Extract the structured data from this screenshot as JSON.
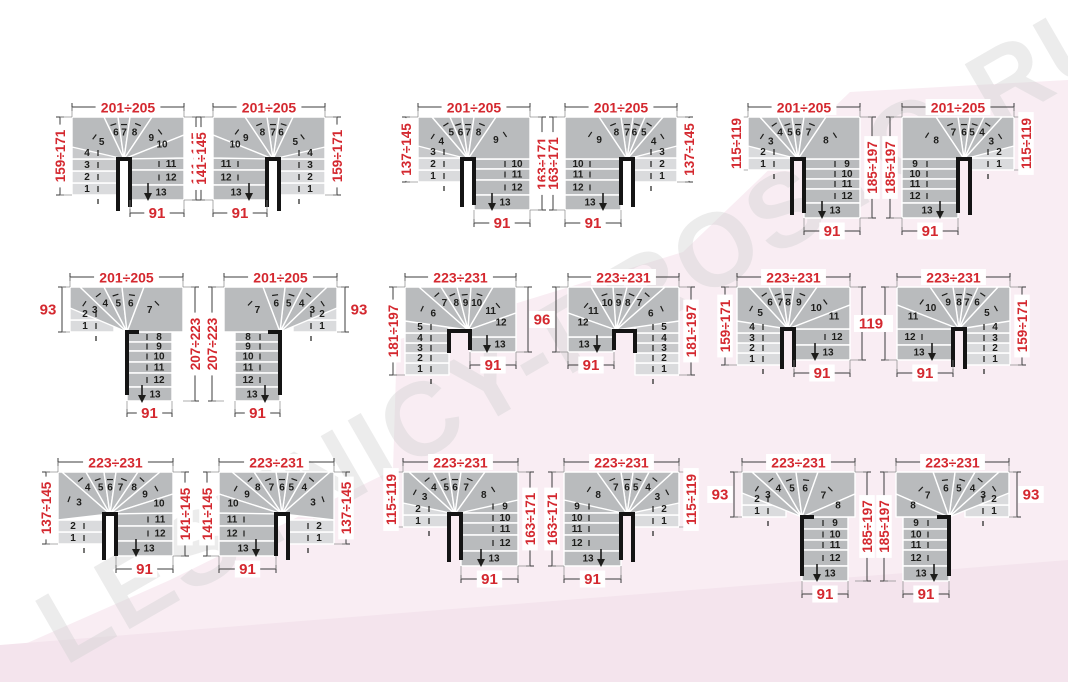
{
  "page": {
    "colors": {
      "background": "#ffffff",
      "pink_main": "#f9edf3",
      "pink_band": "#f4e4ed",
      "accent_red": "#d4282f",
      "step_dark": "#b9bbbd",
      "step_mid": "#c8c9cb",
      "step_light": "#dadbdd",
      "number": "#1d1d1b",
      "dim_line": "#3c3c3c",
      "wall": "#141414",
      "watermark": "#d2d2d2"
    },
    "watermark": {
      "text": "LESTNICY-PROSTO.RU"
    }
  },
  "diagrams": [
    {
      "dims": {
        "top": "201÷205",
        "left": "159÷171",
        "right": "141÷145",
        "bottom": "91"
      },
      "steps": {
        "entry": [
          "1",
          "2",
          "3",
          "4"
        ],
        "fan": [
          "5",
          "6",
          "7",
          "8",
          "9"
        ],
        "side": [
          "10"
        ],
        "flight": [
          "11",
          "12"
        ],
        "exit": "13"
      }
    },
    {
      "dims": {
        "top": "201÷205",
        "left": "141÷145",
        "right": "159÷171",
        "bottom": "91"
      },
      "steps": {
        "entry": [
          "1",
          "2",
          "3",
          "4"
        ],
        "fan": [
          "5",
          "6",
          "7",
          "8",
          "9"
        ],
        "side": [
          "10"
        ],
        "flight": [
          "11",
          "12"
        ],
        "exit": "13"
      }
    },
    {
      "dims": {
        "top": "201÷205",
        "left": "137÷145",
        "right": "163÷171",
        "bottom": "91"
      },
      "steps": {
        "entry": [
          "1",
          "2",
          "3"
        ],
        "fan": [
          "4",
          "5",
          "6",
          "7",
          "8",
          "9"
        ],
        "side": [],
        "flight": [
          "10",
          "11",
          "12"
        ],
        "exit": "13"
      }
    },
    {
      "dims": {
        "top": "201÷205",
        "left": "163÷171",
        "right": "137÷145",
        "bottom": "91"
      },
      "steps": {
        "entry": [
          "1",
          "2",
          "3"
        ],
        "fan": [
          "4",
          "5",
          "6",
          "7",
          "8",
          "9"
        ],
        "side": [],
        "flight": [
          "10",
          "11",
          "12"
        ],
        "exit": "13"
      }
    },
    {
      "dims": {
        "top": "201÷205",
        "left": "115÷119",
        "right": "185÷197",
        "bottom": "91"
      },
      "steps": {
        "entry": [
          "1",
          "2"
        ],
        "fan": [
          "3",
          "4",
          "5",
          "6",
          "7",
          "8"
        ],
        "side": [],
        "flight": [
          "9",
          "10",
          "11",
          "12"
        ],
        "exit": "13"
      }
    },
    {
      "dims": {
        "top": "201÷205",
        "left": "185÷197",
        "right": "115÷119",
        "bottom": "91"
      },
      "steps": {
        "entry": [
          "1",
          "2"
        ],
        "fan": [
          "3",
          "4",
          "5",
          "6",
          "7",
          "8"
        ],
        "side": [],
        "flight": [
          "9",
          "10",
          "11",
          "12"
        ],
        "exit": "13"
      }
    },
    {
      "dims": {
        "top": "201÷205",
        "left": "93",
        "right": "207÷223",
        "bottom": "91"
      },
      "steps": {
        "entry": [
          "1",
          "2"
        ],
        "fan": [
          "3",
          "4",
          "5",
          "6",
          "7"
        ],
        "side": [],
        "flight": [
          "8",
          "9",
          "10",
          "11",
          "12"
        ],
        "exit": "13"
      }
    },
    {
      "dims": {
        "top": "201÷205",
        "left": "207÷223",
        "right": "93",
        "bottom": "91"
      },
      "steps": {
        "entry": [
          "1",
          "2"
        ],
        "fan": [
          "3",
          "4",
          "5",
          "6",
          "7"
        ],
        "side": [],
        "flight": [
          "8",
          "9",
          "10",
          "11",
          "12"
        ],
        "exit": "13"
      }
    },
    {
      "dims": {
        "top": "223÷231",
        "left": "181÷197",
        "right": "96",
        "bottom": "91"
      },
      "steps": {
        "entry": [
          "1",
          "2",
          "3",
          "4",
          "5"
        ],
        "fan": [
          "6",
          "7",
          "8",
          "9",
          "10",
          "11"
        ],
        "side": [
          "12"
        ],
        "flight": [],
        "exit": "13"
      }
    },
    {
      "dims": {
        "top": "223÷231",
        "left": "96",
        "right": "181÷197",
        "bottom": "91"
      },
      "steps": {
        "entry": [
          "1",
          "2",
          "3",
          "4",
          "5"
        ],
        "fan": [
          "6",
          "7",
          "8",
          "9",
          "10",
          "11"
        ],
        "side": [
          "12"
        ],
        "flight": [],
        "exit": "13"
      }
    },
    {
      "dims": {
        "top": "223÷231",
        "left": "159÷171",
        "right": "119",
        "bottom": "91"
      },
      "steps": {
        "entry": [
          "1",
          "2",
          "3",
          "4"
        ],
        "fan": [
          "5",
          "6",
          "7",
          "8",
          "9",
          "10"
        ],
        "side": [
          "11"
        ],
        "flight": [
          "12"
        ],
        "exit": "13"
      }
    },
    {
      "dims": {
        "top": "223÷231",
        "left": "119",
        "right": "159÷171",
        "bottom": "91"
      },
      "steps": {
        "entry": [
          "1",
          "2",
          "3",
          "4"
        ],
        "fan": [
          "5",
          "6",
          "7",
          "8",
          "9",
          "10"
        ],
        "side": [
          "11"
        ],
        "flight": [
          "12"
        ],
        "exit": "13"
      }
    },
    {
      "dims": {
        "top": "223÷231",
        "left": "137÷145",
        "right": "141÷145",
        "bottom": "91"
      },
      "steps": {
        "entry": [
          "1",
          "2"
        ],
        "fan": [
          "3",
          "4",
          "5",
          "6",
          "7",
          "8",
          "9"
        ],
        "side": [
          "10"
        ],
        "flight": [
          "11",
          "12"
        ],
        "exit": "13"
      }
    },
    {
      "dims": {
        "top": "223÷231",
        "left": "141÷145",
        "right": "137÷145",
        "bottom": "91"
      },
      "steps": {
        "entry": [
          "1",
          "2"
        ],
        "fan": [
          "3",
          "4",
          "5",
          "6",
          "7",
          "8",
          "9"
        ],
        "side": [
          "10"
        ],
        "flight": [
          "11",
          "12"
        ],
        "exit": "13"
      }
    },
    {
      "dims": {
        "top": "223÷231",
        "left": "115÷119",
        "right": "163÷171",
        "bottom": "91"
      },
      "steps": {
        "entry": [
          "1",
          "2"
        ],
        "fan": [
          "3",
          "4",
          "5",
          "6",
          "7",
          "8"
        ],
        "side": [],
        "flight": [
          "9",
          "10",
          "11",
          "12"
        ],
        "exit": "13"
      }
    },
    {
      "dims": {
        "top": "223÷231",
        "left": "163÷171",
        "right": "115÷119",
        "bottom": "91"
      },
      "steps": {
        "entry": [
          "1",
          "2"
        ],
        "fan": [
          "3",
          "4",
          "5",
          "6",
          "7",
          "8"
        ],
        "side": [],
        "flight": [
          "9",
          "10",
          "11",
          "12"
        ],
        "exit": "13"
      }
    },
    {
      "dims": {
        "top": "223÷231",
        "left": "93",
        "right": "185÷197",
        "bottom": "91"
      },
      "steps": {
        "entry": [
          "1",
          "2"
        ],
        "fan": [
          "3",
          "4",
          "5",
          "6",
          "7"
        ],
        "side": [
          "8"
        ],
        "flight": [
          "9",
          "10",
          "11",
          "12"
        ],
        "exit": "13"
      }
    },
    {
      "dims": {
        "top": "223÷231",
        "left": "185÷197",
        "right": "93",
        "bottom": "91"
      },
      "steps": {
        "entry": [
          "1",
          "2"
        ],
        "fan": [
          "3",
          "4",
          "5",
          "6",
          "7"
        ],
        "side": [
          "8"
        ],
        "flight": [
          "9",
          "10",
          "11",
          "12"
        ],
        "exit": "13"
      }
    }
  ]
}
